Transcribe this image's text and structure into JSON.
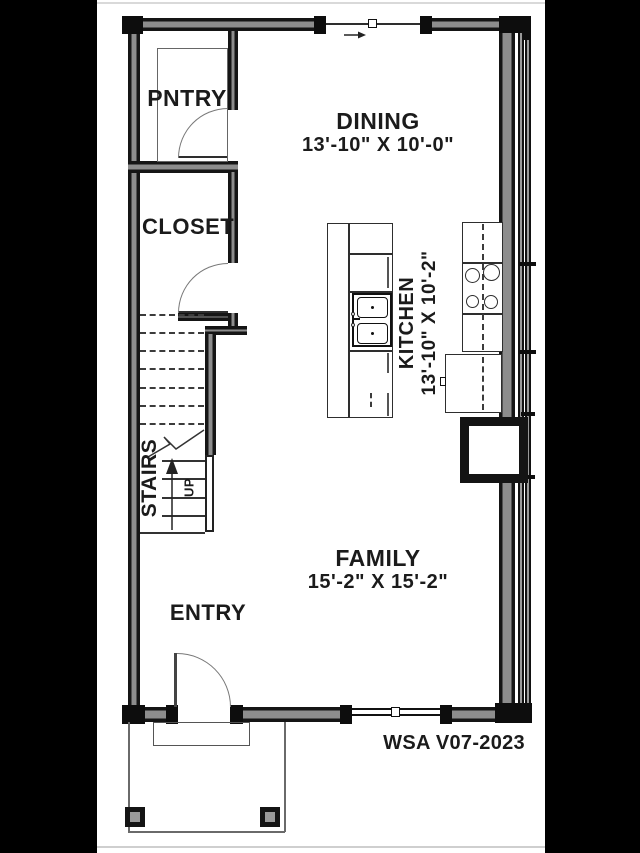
{
  "title_block": {
    "sheet_code": "WSA V07-2023"
  },
  "rooms": {
    "pantry": {
      "label": "PNTRY"
    },
    "closet": {
      "label": "CLOSET"
    },
    "dining": {
      "label": "DINING",
      "dimensions": "13'-10\" X 10'-0\""
    },
    "kitchen": {
      "label": "KITCHEN",
      "dimensions": "13'-10\" X 10'-2\""
    },
    "family": {
      "label": "FAMILY",
      "dimensions": "15'-2\" X 15'-2\""
    },
    "entry": {
      "label": "ENTRY"
    },
    "stairs": {
      "label": "STAIRS",
      "direction_label": "UP"
    }
  },
  "colors": {
    "wall": "#141414",
    "wall_core": "#8d8d8d",
    "line": "#2e2e2e",
    "paper": "#ffffff",
    "backdrop": "#000000"
  }
}
